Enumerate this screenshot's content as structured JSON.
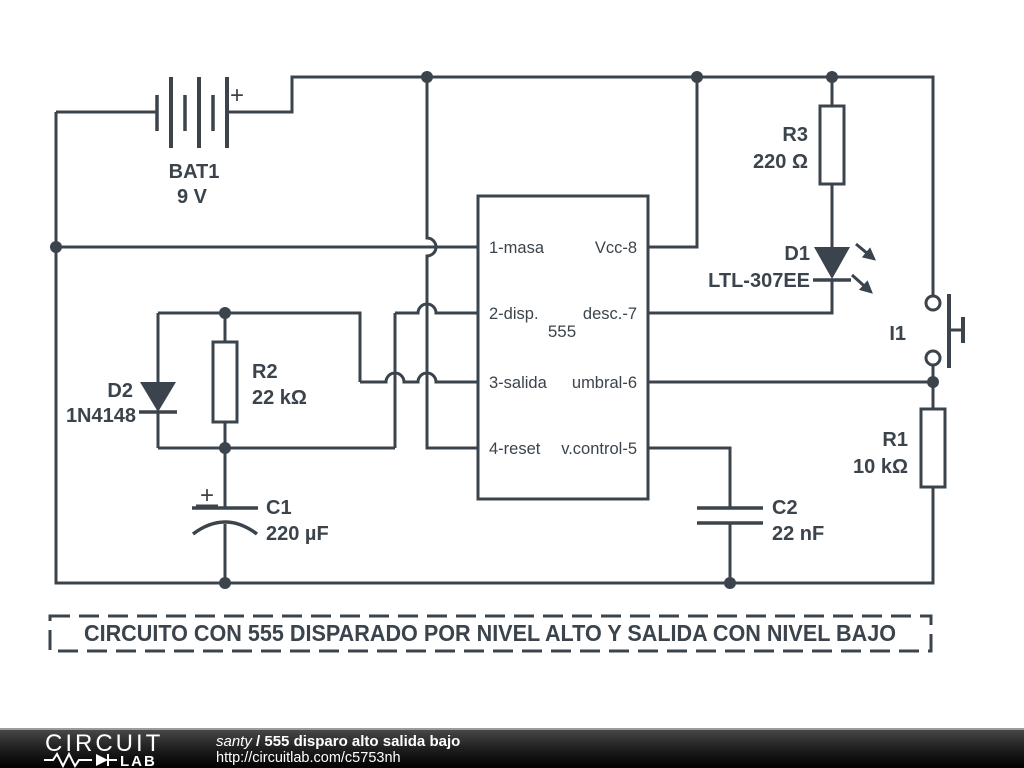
{
  "schematic": {
    "title_box": "CIRCUITO CON 555 DISPARADO POR NIVEL ALTO Y SALIDA CON NIVEL BAJO",
    "battery": {
      "ref": "BAT1",
      "value": "9 V",
      "polarity": "+"
    },
    "ic555": {
      "label": "555",
      "pin1": "1-masa",
      "pin2": "2-disp.",
      "pin3": "3-salida",
      "pin4": "4-reset",
      "pin8": "Vcc-8",
      "pin7": "desc.-7",
      "pin6": "umbral-6",
      "pin5": "v.control-5"
    },
    "r1": {
      "ref": "R1",
      "value": "10 kΩ"
    },
    "r2": {
      "ref": "R2",
      "value": "22 kΩ"
    },
    "r3": {
      "ref": "R3",
      "value": "220 Ω"
    },
    "c1": {
      "ref": "C1",
      "value": "220 µF",
      "polarity": "+"
    },
    "c2": {
      "ref": "C2",
      "value": "22 nF"
    },
    "d1": {
      "ref": "D1",
      "value": "LTL-307EE"
    },
    "d2": {
      "ref": "D2",
      "value": "1N4148"
    },
    "i1": {
      "ref": "I1"
    }
  },
  "footer": {
    "logo_word_top": "CIRCUIT",
    "logo_word_bottom": "LAB",
    "author": "santy",
    "separator": "/",
    "doc_title": "555 disparo alto salida bajo",
    "url": "http://circuitlab.com/c5753nh"
  },
  "colors": {
    "schematic_ink": "#3b444c",
    "footer_bg_top": "#474747",
    "footer_bg_bottom": "#000000"
  }
}
